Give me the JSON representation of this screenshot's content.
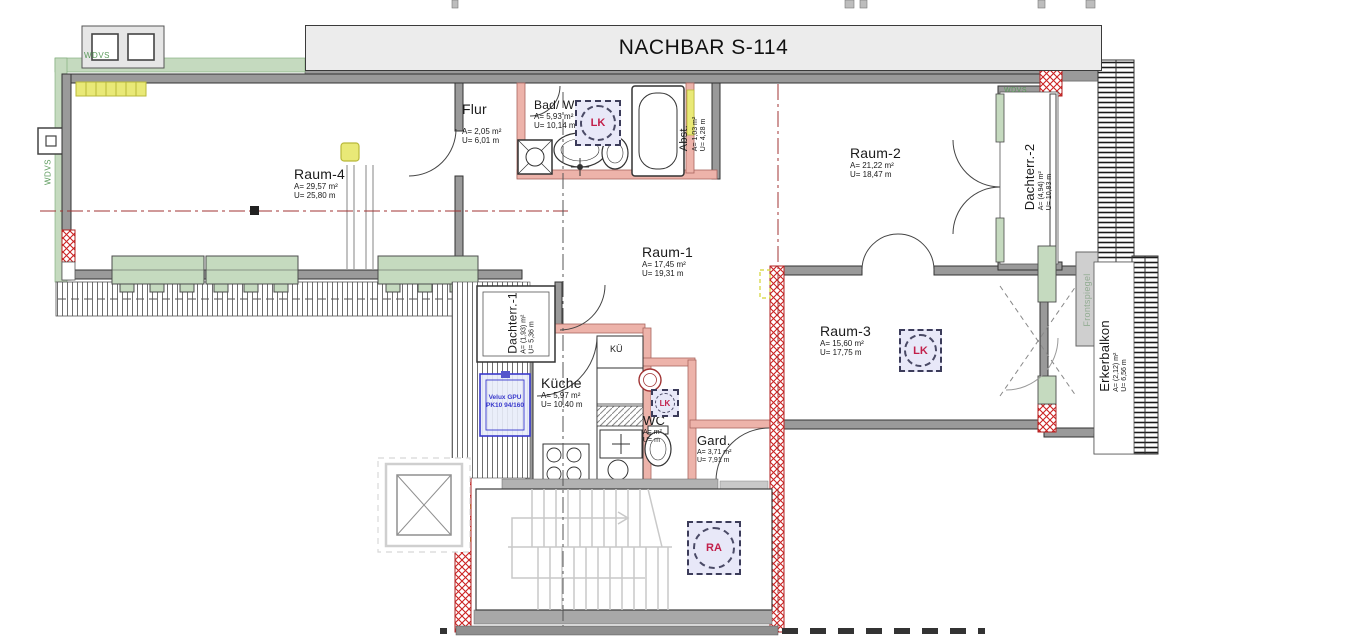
{
  "banner": {
    "text": "NACHBAR S-114"
  },
  "rooms": [
    {
      "name": "Raum-4",
      "area": "A= 29,57 m²",
      "perimeter": "U= 25,80 m"
    },
    {
      "name": "Flur",
      "area": "A= 2,05 m²",
      "perimeter": "U= 6,01 m"
    },
    {
      "name": "Bad/ WC-1",
      "area": "A= 5,93 m²",
      "perimeter": "U= 10,14 m"
    },
    {
      "name": "Abst.",
      "area": "A= 1,03 m²",
      "perimeter": "U= 4,28 m"
    },
    {
      "name": "Raum-2",
      "area": "A= 21,22 m²",
      "perimeter": "U= 18,47 m"
    },
    {
      "name": "Dachterr.-2",
      "area": "A= (4,94) m²",
      "perimeter": "U= 10,83 m"
    },
    {
      "name": "Raum-1",
      "area": "A= 17,45 m²",
      "perimeter": "U= 19,31 m"
    },
    {
      "name": "Dachterr.-1",
      "area": "A= (1,93) m²",
      "perimeter": "U= 5,36 m"
    },
    {
      "name": "Raum-3",
      "area": "A= 15,60 m²",
      "perimeter": "U= 17,75 m"
    },
    {
      "name": "Küche",
      "area": "A= 5,97 m²",
      "perimeter": "U= 10,40 m"
    },
    {
      "name": "WC",
      "area": "A= m²",
      "perimeter": "U= m"
    },
    {
      "name": "Gard.",
      "area": "A= 3,71 m²",
      "perimeter": "U= 7,91 m"
    },
    {
      "name": "Erkerbalkon",
      "area": "A= (2,12) m²",
      "perimeter": "U= 6,56 m"
    }
  ],
  "labels": {
    "ku": "KÜ",
    "wdvs": "WDVS",
    "frontspiegel": "Frontspiegel",
    "velux_line1": "Velux GPU",
    "velux_line2": "PK10 94/160"
  },
  "markers": {
    "lk": "LK",
    "ra": "RA"
  },
  "colors": {
    "wdvs_green": "#c5dabf",
    "wall_gray": "#9a9a9a",
    "new_wall_red": "#cc2222",
    "existing_pink": "#edb3aa",
    "highlight_yellow": "#e9e977",
    "marker_fill": "#e8e8f8",
    "marker_text": "#c21f4a",
    "velux_blue": "#3a3acc",
    "axis_red": "#a03333"
  }
}
